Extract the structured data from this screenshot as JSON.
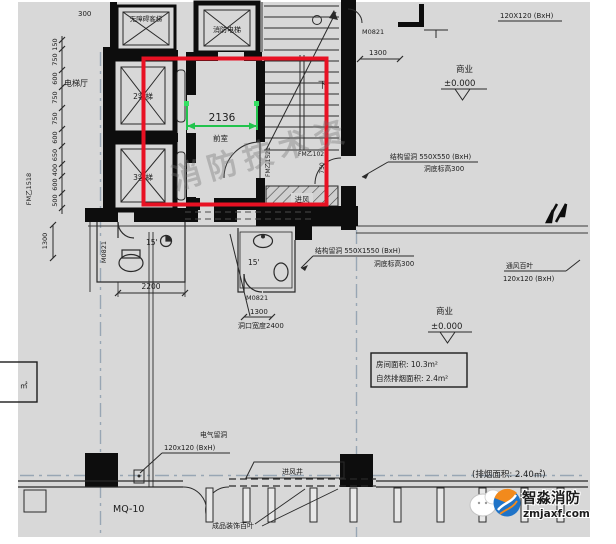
{
  "colors": {
    "paper": "#d8d8d8",
    "line": "#2a2a2a",
    "wall": "#0d0d0d",
    "highlight_box": "#e81123",
    "dimension_green": "#22c34d",
    "grid": "#98a6b4",
    "logo_red": "#d92b1a",
    "logo_blue": "#1f73c7",
    "logo_orange": "#f28a1c"
  },
  "labels": {
    "elevator_hall": "电梯厅",
    "accessible_elevator": "无障碍客梯",
    "fire_elevator": "消防电梯",
    "elevator_2": "2客梯",
    "elevator_3": "3客梯",
    "vestibule": "前室",
    "stair_down": "下",
    "air_inlet": "进风",
    "air_inlet_shaft": "进风井",
    "commerce_top": "商业",
    "level_top": "±0.000",
    "commerce_mid": "商业",
    "level_mid": "±0.000",
    "mq10": "MQ-10",
    "louver_note": "成品装饰百叶",
    "drain_left": "15'",
    "drain_right": "15'",
    "partial_label": "㎡",
    "watermark": "消防技术资"
  },
  "doors": {
    "fm1518": "FM乙1518",
    "fm1521": "FM乙1521",
    "fm1021": "FM乙1021",
    "m0821_top": "M0821",
    "m0821_left": "M0821",
    "m0821_mid": "M0821"
  },
  "dims": {
    "green": "2136",
    "d2200": "2200",
    "d1300_left": "1300",
    "d1300_top": "1300",
    "d1300_mid": "1300",
    "d750": "750",
    "d300": "300",
    "chain": [
      "150",
      "750",
      "600",
      "750",
      "750",
      "600",
      "650",
      "400",
      "600",
      "500"
    ]
  },
  "notes": {
    "top_hole": "120X120 (BxH)",
    "struct_hole_small": "结构留洞 550X550 (BxH)",
    "struct_hole_small_base": "洞底标高300",
    "struct_hole_large": "结构留洞 550X1550 (BxH)",
    "struct_hole_large_base": "洞底标高300",
    "vent_louver": "通风百叶",
    "vent_louver_size": "120x120 (BxH)",
    "elec_hole": "电气留洞",
    "elec_hole_size": "120x120 (BxH)",
    "opening_width": "洞口宽度2400",
    "room_area": "房间面积: 10.3m²",
    "natural_smoke_area": "自然排烟面积: 2.4m²",
    "smoke_area": "(排烟面积: 2.40㎡)"
  },
  "logo": {
    "brand": "智淼消防",
    "site": "zmjaxf.com"
  }
}
